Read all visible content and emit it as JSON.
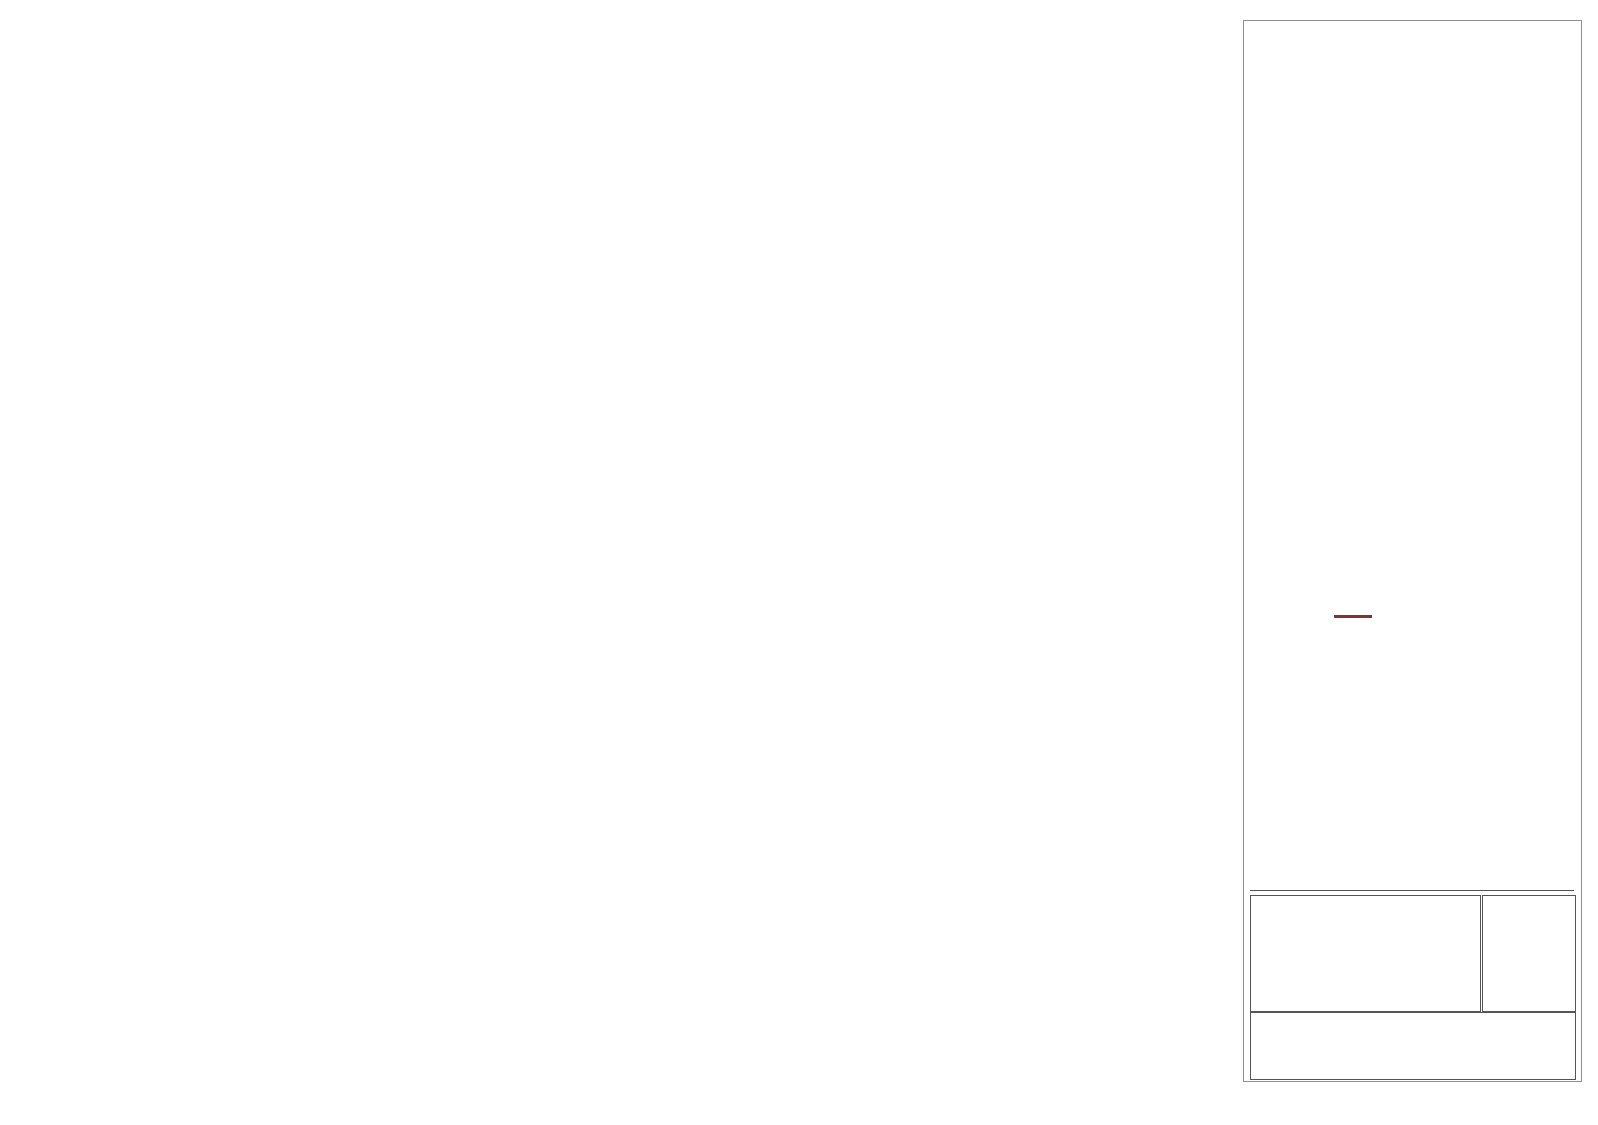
{
  "plan_map": {
    "hole_label": "CBD11001",
    "tolerance_labels": {
      "top": "-25 m",
      "bottom": "+25 m"
    },
    "colors": {
      "bg": "#85D201",
      "trace_fill": "#2BEF2B",
      "band": "#E2931D",
      "grid_line": "#3b3b2a",
      "dashed_line": "#cc3b00",
      "tolerance_text": "#ff0000",
      "collar": "#1f6fd4"
    },
    "grid_labels": [
      {
        "t": "8955800 N",
        "x": 86,
        "y": 45,
        "r": 45
      },
      {
        "t": "186500 E",
        "x": 156,
        "y": 46,
        "r": -50
      },
      {
        "t": "8955850 N",
        "x": 263,
        "y": 44,
        "r": 45
      },
      {
        "t": "186550 E",
        "x": 306,
        "y": 46,
        "r": -50
      },
      {
        "t": "8955900 N",
        "x": 440,
        "y": 45,
        "r": 45
      },
      {
        "t": "186600 E",
        "x": 452,
        "y": 46,
        "r": -50
      },
      {
        "t": "8955950 N",
        "x": 612,
        "y": 45,
        "r": 45
      },
      {
        "t": "186650 E",
        "x": 600,
        "y": 46,
        "r": -50
      },
      {
        "t": "186700 E",
        "x": 752,
        "y": 44,
        "r": -50
      },
      {
        "t": "8956000 N",
        "x": 797,
        "y": 42,
        "r": 45
      },
      {
        "t": "186750 E",
        "x": 901,
        "y": 44,
        "r": -50
      },
      {
        "t": "8956050 N",
        "x": 973,
        "y": 46,
        "r": 45
      },
      {
        "t": "186800 E",
        "x": 1050,
        "y": 45,
        "r": -50
      },
      {
        "t": "186850 E",
        "x": 1196,
        "y": 46,
        "r": -50
      },
      {
        "t": "186500 E",
        "x": 46,
        "y": 178,
        "r": -50
      },
      {
        "t": "186550 E",
        "x": 175,
        "y": 200,
        "r": -50
      },
      {
        "t": "8955800 N",
        "x": 273,
        "y": 197,
        "r": 45
      },
      {
        "t": "186600 E",
        "x": 334,
        "y": 200,
        "r": -50
      },
      {
        "t": "8955850 N",
        "x": 450,
        "y": 200,
        "r": 45
      },
      {
        "t": "186650 E",
        "x": 462,
        "y": 200,
        "r": -50
      },
      {
        "t": "8955900 N",
        "x": 628,
        "y": 200,
        "r": 45
      },
      {
        "t": "186700 E",
        "x": 648,
        "y": 200,
        "r": -50
      },
      {
        "t": "186750 E",
        "x": 765,
        "y": 200,
        "r": -50
      },
      {
        "t": "8955950 N",
        "x": 803,
        "y": 199,
        "r": 45
      },
      {
        "t": "8956000 N",
        "x": 985,
        "y": 202,
        "r": 45
      },
      {
        "t": "186800 E",
        "x": 1070,
        "y": 202,
        "r": -50
      },
      {
        "t": "8956050 N",
        "x": 1160,
        "y": 207,
        "r": 45
      }
    ],
    "n_line_x0": [
      -122,
      55,
      232,
      409,
      586,
      763,
      940,
      1117,
      1294
    ],
    "e_line_x0": [
      26,
      176,
      326,
      476,
      626,
      776,
      921,
      1070,
      1216,
      1366
    ],
    "dashed_line_ys": [
      66,
      123,
      180
    ],
    "trace_rect": {
      "x1": 292,
      "y1": 117,
      "x2": 810,
      "y2": 143,
      "divider_x": 511
    },
    "collar": {
      "x": 811,
      "y": 117,
      "label_x": 820,
      "label_y": 104
    }
  },
  "section": {
    "frame": {
      "x1": 25,
      "y1": 270,
      "x2": 1205,
      "y2": 1012
    },
    "colors": {
      "grid": "#c9c9c9",
      "frame": "#3c3c3c",
      "axis_text": "#8a8a8a",
      "topo": "#7a3232",
      "trace": "#111111",
      "arrow": "#111111"
    },
    "rl_lines": [
      {
        "l": "3850 RL",
        "y": 328
      },
      {
        "l": "3800 RL",
        "y": 441
      },
      {
        "l": "3750 RL",
        "y": 555
      },
      {
        "l": "3700 RL",
        "y": 669
      },
      {
        "l": "3650 RL",
        "y": 782
      },
      {
        "l": "3600 RL",
        "y": 896
      },
      {
        "l": "3550 RL",
        "y": 1010
      }
    ],
    "ticks": [
      {
        "l": "186500 E",
        "x": 91
      },
      {
        "l": "8955800 N",
        "x": 180
      },
      {
        "l": "186550 E",
        "x": 238
      },
      {
        "l": "8955850 N",
        "x": 357
      },
      {
        "l": "186600 E",
        "x": 388
      },
      {
        "l": "8955900 N",
        "x": 535
      },
      {
        "l": "186650 E",
        "x": 537
      },
      {
        "l": "186700 E",
        "x": 688
      },
      {
        "l": "8955950 N",
        "x": 712
      },
      {
        "l": "186750 E",
        "x": 837
      },
      {
        "l": "8956000 N",
        "x": 890
      },
      {
        "l": "186800 E",
        "x": 986
      },
      {
        "l": "8956050 N",
        "x": 1068
      },
      {
        "l": "186850 E",
        "x": 1135
      }
    ],
    "topo_points": [
      [
        25,
        666
      ],
      [
        60,
        652
      ],
      [
        100,
        622
      ],
      [
        148,
        588
      ],
      [
        185,
        553
      ],
      [
        232,
        515
      ],
      [
        272,
        482
      ],
      [
        312,
        446
      ],
      [
        352,
        415
      ],
      [
        395,
        391
      ],
      [
        432,
        375
      ],
      [
        468,
        363
      ],
      [
        500,
        358
      ],
      [
        532,
        356
      ],
      [
        565,
        360
      ],
      [
        600,
        369
      ],
      [
        640,
        378
      ],
      [
        680,
        382
      ],
      [
        725,
        387
      ],
      [
        760,
        393
      ],
      [
        800,
        400
      ],
      [
        835,
        406
      ],
      [
        868,
        409
      ],
      [
        895,
        409
      ],
      [
        922,
        402
      ],
      [
        952,
        391
      ],
      [
        982,
        381
      ],
      [
        1012,
        362
      ],
      [
        1042,
        348
      ],
      [
        1072,
        342
      ],
      [
        1102,
        337
      ],
      [
        1132,
        333
      ],
      [
        1162,
        329
      ],
      [
        1186,
        323
      ],
      [
        1205,
        317
      ]
    ],
    "hole": {
      "label": "CBD11001",
      "label_x": 305,
      "label_y": 1008,
      "x1": 308,
      "y1": 1012,
      "x2": 803,
      "y2": 391
    },
    "intervals": [
      {
        "cx": 746,
        "cy": 453,
        "len": 17,
        "w": 2,
        "color": "#b0b0b0"
      },
      {
        "cx": 757,
        "cy": 467,
        "len": 17,
        "w": 3,
        "color": "#ff1212"
      },
      {
        "cx": 655,
        "cy": 571,
        "len": 16,
        "w": 7,
        "color": "#00e53c"
      },
      {
        "cx": 668,
        "cy": 583,
        "len": 16,
        "w": 7,
        "color": "#f40000"
      },
      {
        "cx": 650,
        "cy": 578,
        "len": 19,
        "w": 2,
        "color": "#ff5555"
      },
      {
        "cx": 661,
        "cy": 590,
        "len": 10,
        "w": 4,
        "color": "#8400ff"
      },
      {
        "cx": 552,
        "cy": 706,
        "len": 16,
        "w": 2,
        "color": "#f09090"
      },
      {
        "cx": 456,
        "cy": 818,
        "len": 13,
        "w": 3,
        "color": "#00e53c"
      },
      {
        "cx": 463,
        "cy": 830,
        "len": 13,
        "w": 3,
        "color": "#ff1212"
      },
      {
        "cx": 448,
        "cy": 845,
        "len": 27,
        "w": 9,
        "color": "#f40000"
      }
    ],
    "callouts": [
      {
        "text": "0.75m @ 1.04 g/t Au",
        "x": 353,
        "y": 415,
        "w": 357,
        "h": 55
      },
      {
        "text": "0. 5m @ 19.6 g/t Au, 44.5 g/t Ag",
        "x": 767,
        "y": 473,
        "w": 518,
        "h": 55
      },
      {
        "text": "7.05m @ 1.8 g/t Au, 23.3 g/t Ag",
        "x": 667,
        "y": 587,
        "w": 517,
        "h": 53
      },
      {
        "text": "0. 5m @ 1.1 g/t Au, 4.8 g/t Ag",
        "x": 80,
        "y": 604,
        "w": 483,
        "h": 55
      },
      {
        "text": "3.5m @ 0.9 g/t Au, 0.5 g/t Ag",
        "x": 528,
        "y": 783,
        "w": 462,
        "h": 55
      },
      {
        "text": "1.9m @ 0.5 g/t Au, 16.6 g/t Ag",
        "x": 480,
        "y": 862,
        "w": 490,
        "h": 53
      },
      {
        "text": "1.0m @ 0.5 g/t Au, 97.9 g/t Ag",
        "x": 413,
        "y": 958,
        "w": 487,
        "h": 53
      }
    ],
    "arrows": [
      [
        708,
        442,
        736,
        450
      ],
      [
        793,
        516,
        753,
        478
      ],
      [
        698,
        636,
        653,
        596
      ],
      [
        95,
        622,
        63,
        597
      ],
      [
        345,
        659,
        540,
        699
      ],
      [
        528,
        808,
        464,
        841
      ],
      [
        480,
        884,
        459,
        862
      ],
      [
        426,
        958,
        439,
        868
      ]
    ]
  },
  "sidebar": {
    "holes_plotted": {
      "title": "HOLES PLOTTED",
      "total": "TOTAL 1",
      "hole": "CBD11001"
    },
    "logo": {
      "left": "DA",
      "u": "U",
      "right": "RA",
      "sub": "GOLD CORP",
      "navy": "#223A52",
      "orange": "#C5823D",
      "star": "#D98E2B"
    },
    "topography": {
      "title": "TOPOGRAPHY",
      "file": "1topo.GRD",
      "line_color": "#7b3535"
    },
    "legends": [
      {
        "h1": "NUMBER BANDS",
        "h2": "L/R",
        "h3": "COL",
        "h4": "RANGE",
        "field": "Ag_ppm",
        "lr": "L",
        "colors": [
          "#8A00FF",
          "#FF0000",
          "#00F03C",
          "#0000FF",
          "#C9C9C9"
        ],
        "ranges": [
          "300",
          "60",
          "30",
          "10"
        ]
      },
      {
        "h1": "NUMBER BANDS",
        "h2": "L/R",
        "h3": "COL",
        "h4": "RANGE",
        "field": "AuEq_ppm",
        "lr": "R",
        "colors": [
          "#8A00FF",
          "#FF0000",
          "#00F03C",
          "#0000FF",
          "#C9C9C9"
        ],
        "ranges": [
          "5",
          "1",
          "0.5",
          "0.2"
        ]
      }
    ],
    "section_specs": {
      "title": "SECTION  SPECS:",
      "rows": [
        {
          "label": "REF. PT.  E, N",
          "v1": "186679 m",
          "v2": "8955925 m"
        },
        {
          "label": "EXTENTS",
          "v1": "527 m",
          "v2": "363.1 m"
        },
        {
          "label": "SECTION TOP, BOT",
          "v1": "3876 m",
          "v2": "3513 m"
        },
        {
          "label": "TOLERANCE  +/-",
          "v1": "25 m",
          "v2": ""
        }
      ]
    },
    "scale": {
      "title": "SCALE",
      "unit": "(m)",
      "ticks": [
        "-10",
        "0",
        "10",
        "20",
        "30",
        "40",
        "50",
        "60"
      ],
      "datum": "WGS 84 / UTM zone 18S"
    },
    "azimuth": {
      "label": "AZIMUTH = 50°",
      "n": "N",
      "e": "E",
      "s": "S",
      "w": "W"
    },
    "title_block": [
      "Daura Gold Corp",
      "Antonela Project",
      "Hole ID CBD11001"
    ]
  },
  "chart_data": {
    "type": "cross-section",
    "title": "Daura Gold Corp - Antonela Project - Hole ID CBD11001",
    "hole_id": "CBD11001",
    "rl_ticks": [
      3850,
      3800,
      3750,
      3700,
      3650,
      3600,
      3550
    ],
    "easting_ticks": [
      186500,
      186550,
      186600,
      186650,
      186700,
      186750,
      186800,
      186850
    ],
    "northing_ticks": [
      8955800,
      8955850,
      8955900,
      8955950,
      8956000,
      8956050
    ],
    "azimuth_deg": 50,
    "intercepts": [
      "0.75m @ 1.04 g/t Au",
      "0. 5m @ 19.6 g/t Au, 44.5 g/t Ag",
      "7.05m @ 1.8 g/t Au, 23.3 g/t Ag",
      "0. 5m @ 1.1 g/t Au, 4.8 g/t Ag",
      "3.5m @ 0.9 g/t Au, 0.5 g/t Ag",
      "1.9m @ 0.5 g/t Au, 16.6 g/t Ag",
      "1.0m @ 0.5 g/t Au, 97.9 g/t Ag"
    ]
  }
}
